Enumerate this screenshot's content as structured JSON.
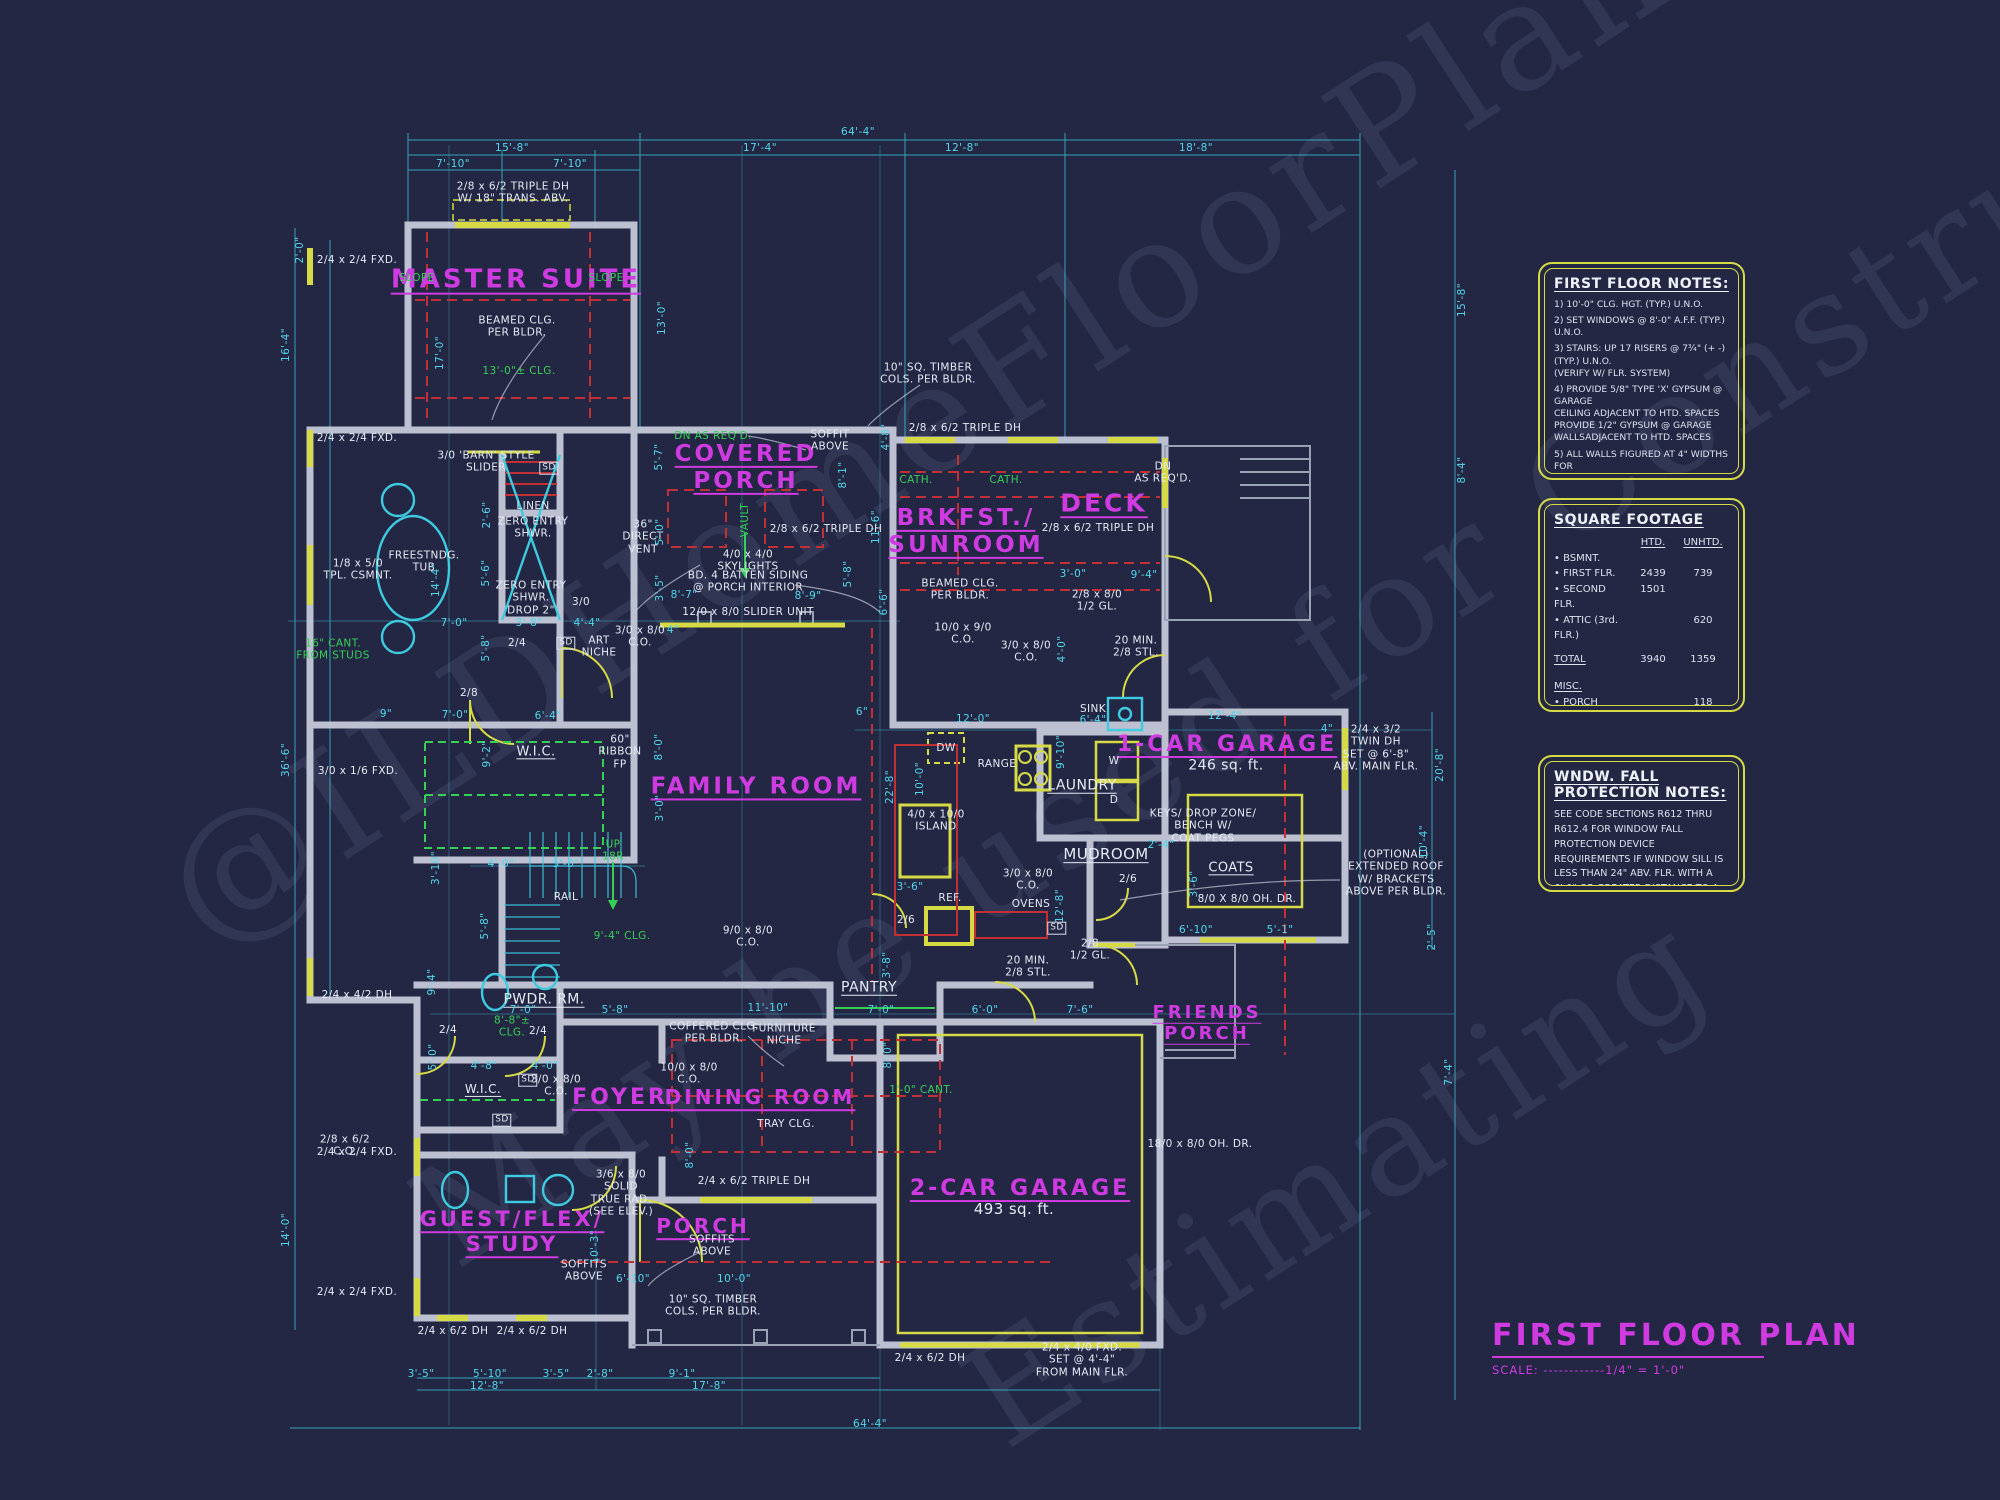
{
  "palette": {
    "background": "#232744",
    "cyan": "#4fd8ea",
    "magenta": "#cf3be0",
    "yellow": "#d6db45",
    "green": "#35d054",
    "red": "#c22f35",
    "white": "#e8ecf4",
    "wall": "#c9cede"
  },
  "watermark": {
    "lines": [
      "@ILDHomeFloorPlans.com",
      "May be used for Construction",
      "Estimating"
    ]
  },
  "title_block": {
    "title": "FIRST FLOOR PLAN",
    "scale": "SCALE: ------------1/4\" = 1'-0\""
  },
  "first_floor_notes": {
    "title": "FIRST FLOOR NOTES:",
    "items": [
      "1) 10'-0\"  CLG. HGT. (TYP.) U.N.O.",
      "2) SET WINDOWS @ 8'-0\" A.F.F. (TYP.) U.N.O.",
      "3) STAIRS: UP 17 RISERS @ 7¾\" (+ -)  (TYP.) U.N.O.\n    (VERIFY W/ FLR. SYSTEM)",
      "4) PROVIDE 5/8\" TYPE 'X' GYPSUM @ GARAGE\n    CEILING ADJACENT TO HTD. SPACES\n    PROVIDE 1/2\" GYPSUM @ GARAGE\n    WALLSADJACENT TO HTD. SPACES",
      "5) ALL WALLS FIGURED AT 4\" WIDTHS FOR\n    FOR STUDS, 9\" WIDTHS FOR STUD/BRICK\n    (TYP.) U.N.O.",
      "6) VERIFY ROUGH OPNG'S,SPECS. FOR CODE\n    REQUIREMENTS WITH WINDOW MANUF.",
      "7) SD = SMOKE DETECTOR",
      "8) INT. DOORS TO BE 8'-0\" H. (VERIFY W/ BLDR.)"
    ]
  },
  "square_footage": {
    "title": "SQUARE FOOTAGE",
    "col_htd": "HTD.",
    "col_unhtd": "UNHTD.",
    "rows": [
      {
        "l": "• BSMNT.",
        "h": "",
        "u": ""
      },
      {
        "l": "• FIRST FLR.",
        "h": "2439",
        "u": "739"
      },
      {
        "l": "• SECOND FLR.",
        "h": "1501",
        "u": ""
      },
      {
        "l": "• ATTIC (3rd. FLR.)",
        "h": "",
        "u": "620"
      }
    ],
    "total": {
      "l": "TOTAL",
      "h": "3940",
      "u": "1359"
    },
    "misc_label": "MISC.",
    "misc_rows": [
      {
        "l": "• PORCH",
        "u": "118"
      },
      {
        "l": "• COVERED PORCH",
        "u": "243"
      },
      {
        "l": "• FRIENDS PORCH",
        "u": "15"
      },
      {
        "l": "• DECK",
        "u": "96"
      },
      {
        "l": "•",
        "u": ""
      }
    ]
  },
  "fall_protection": {
    "title": "WNDW. FALL PROTECTION NOTES:",
    "body": "SEE CODE SECTIONS R612 THRU R612.4 FOR WINDOW FALL PROTECTION DEVICE REQUIREMENTS IF WINDOW SILL IS LESS THAN 24\" ABV. FLR. WITH A 6'-0\" OR GREATER DISTANCE TO A SURFACE OUTSIDE AND BELOW THE WINDOW."
  },
  "plan": {
    "rooms": [
      {
        "t": "MASTER SUITE",
        "x": 516,
        "y": 280,
        "s": 26
      },
      {
        "t": "COVERED\nPORCH",
        "x": 746,
        "y": 468,
        "s": 23
      },
      {
        "t": "BRKFST./\nSUNROOM",
        "x": 966,
        "y": 532,
        "s": 23
      },
      {
        "t": "DECK",
        "x": 1104,
        "y": 503,
        "s": 25
      },
      {
        "t": "FAMILY ROOM",
        "x": 756,
        "y": 787,
        "s": 23
      },
      {
        "t": "1-CAR GARAGE",
        "x": 1227,
        "y": 745,
        "s": 22
      },
      {
        "t": "FRIENDS\nPORCH",
        "x": 1207,
        "y": 1023,
        "s": 18
      },
      {
        "t": "FOYER",
        "x": 620,
        "y": 1098,
        "s": 22
      },
      {
        "t": "DINING ROOM",
        "x": 760,
        "y": 1098,
        "s": 20
      },
      {
        "t": "2-CAR GARAGE",
        "x": 1020,
        "y": 1189,
        "s": 22
      },
      {
        "t": "GUEST/FLEX/\nSTUDY",
        "x": 512,
        "y": 1232,
        "s": 21
      },
      {
        "t": "PORCH",
        "x": 703,
        "y": 1227,
        "s": 20
      }
    ],
    "annotations": [
      {
        "t": "2/8 x 6/2 TRIPLE DH\nW/ 18\" TRANS. ABV.",
        "x": 513,
        "y": 193
      },
      {
        "t": "SLOPE",
        "x": 417,
        "y": 278,
        "c": "g"
      },
      {
        "t": "SLOPE",
        "x": 606,
        "y": 278,
        "c": "g"
      },
      {
        "t": "BEAMED CLG.\nPER BLDR.",
        "x": 517,
        "y": 327
      },
      {
        "t": "13'-0\"± CLG.",
        "x": 519,
        "y": 371,
        "c": "g"
      },
      {
        "t": "2/4 x 2/4 FXD.",
        "x": 357,
        "y": 260
      },
      {
        "t": "2/4 x 2/4 FXD.",
        "x": 357,
        "y": 438
      },
      {
        "t": "3/0 'BARN' STYLE\nSLIDER",
        "x": 486,
        "y": 462
      },
      {
        "t": "SD",
        "x": 549,
        "y": 468,
        "b": 1
      },
      {
        "t": "LINEN",
        "x": 533,
        "y": 506
      },
      {
        "t": "ZERO ENTRY\nSHWR.",
        "x": 533,
        "y": 528
      },
      {
        "t": "ZERO ENTRY\nSHWR.\nDROP 2\"",
        "x": 531,
        "y": 598
      },
      {
        "t": "FREESTNDG.\nTUB",
        "x": 424,
        "y": 562
      },
      {
        "t": "1/8 x 5/0\nTPL. CSMNT.",
        "x": 358,
        "y": 570
      },
      {
        "t": "16\" CANT.\nFROM STUDS",
        "x": 333,
        "y": 650,
        "c": "g"
      },
      {
        "t": "3/0",
        "x": 581,
        "y": 602
      },
      {
        "t": "2/4",
        "x": 517,
        "y": 643
      },
      {
        "t": "SD",
        "x": 566,
        "y": 643,
        "b": 1
      },
      {
        "t": "ART\nNICHE",
        "x": 599,
        "y": 647
      },
      {
        "t": "2/8",
        "x": 469,
        "y": 693
      },
      {
        "t": "DN AS REQ'D.",
        "x": 713,
        "y": 436,
        "c": "g"
      },
      {
        "t": "SOFFIT\nABOVE",
        "x": 830,
        "y": 441
      },
      {
        "t": "VAULT",
        "x": 745,
        "y": 520,
        "c": "g",
        "v": 1
      },
      {
        "t": "2/8 x 6/2 TRIPLE DH",
        "x": 826,
        "y": 529
      },
      {
        "t": "36\"\nDIRECT\nVENT",
        "x": 643,
        "y": 537
      },
      {
        "t": "4/0 x 4/0\nSKYLIGHTS",
        "x": 748,
        "y": 561
      },
      {
        "t": "BD. 4 BATTEN SIDING\n@ PORCH INTERIOR",
        "x": 748,
        "y": 582
      },
      {
        "t": "12/0 x 8/0 SLIDER UNIT",
        "x": 748,
        "y": 612
      },
      {
        "t": "3/0 x 8/0\nC.O.",
        "x": 640,
        "y": 637
      },
      {
        "t": "10\" SQ. TIMBER\nCOLS. PER BLDR.",
        "x": 928,
        "y": 374
      },
      {
        "t": "2/8 x 6/2 TRIPLE DH",
        "x": 965,
        "y": 428
      },
      {
        "t": "CATH.",
        "x": 916,
        "y": 480,
        "c": "g"
      },
      {
        "t": "CATH.",
        "x": 1006,
        "y": 480,
        "c": "g"
      },
      {
        "t": "BEAMED CLG.\nPER BLDR.",
        "x": 960,
        "y": 590
      },
      {
        "t": "10/0 x 9/0\nC.O.",
        "x": 963,
        "y": 634
      },
      {
        "t": "3/0 x 8/0\nC.O.",
        "x": 1026,
        "y": 652
      },
      {
        "t": "DN\nAS REQ'D.",
        "x": 1163,
        "y": 473
      },
      {
        "t": "2/8 x 6/2 TRIPLE DH",
        "x": 1098,
        "y": 528
      },
      {
        "t": "2/8 x 8/0\n1/2 GL.",
        "x": 1097,
        "y": 601
      },
      {
        "t": "20 MIN.\n2/8 STL.",
        "x": 1136,
        "y": 647
      },
      {
        "t": "SINK",
        "x": 1093,
        "y": 709
      },
      {
        "t": "W",
        "x": 1114,
        "y": 761
      },
      {
        "t": "D",
        "x": 1114,
        "y": 800
      },
      {
        "t": "DW",
        "x": 946,
        "y": 748
      },
      {
        "t": "RANGE",
        "x": 997,
        "y": 764
      },
      {
        "t": "4/0 x 10/0\nISLAND",
        "x": 936,
        "y": 821
      },
      {
        "t": "REF.",
        "x": 950,
        "y": 898
      },
      {
        "t": "OVENS",
        "x": 1031,
        "y": 904
      },
      {
        "t": "3/0 x 8/0\nC.O.",
        "x": 1028,
        "y": 880
      },
      {
        "t": "2/6",
        "x": 906,
        "y": 920
      },
      {
        "t": "2/6",
        "x": 1128,
        "y": 879
      },
      {
        "t": "9/0 x 8/0\nC.O.",
        "x": 748,
        "y": 937
      },
      {
        "t": "SD",
        "x": 1057,
        "y": 928,
        "b": 1
      },
      {
        "t": "KEYS/ DROP ZONE/\nBENCH W/\nCOAT PEGS",
        "x": 1203,
        "y": 826
      },
      {
        "t": "8/0 X 8/0 OH. DR.",
        "x": 1247,
        "y": 899
      },
      {
        "t": "2/4 x 3/2\nTWIN DH\nSET @ 6'-8\"\nABV. MAIN FLR.",
        "x": 1376,
        "y": 748
      },
      {
        "t": "(OPTIONAL)\nEXTENDED ROOF\nW/ BRACKETS\nABOVE PER BLDR.",
        "x": 1396,
        "y": 873
      },
      {
        "t": "2/8\n1/2 GL.",
        "x": 1090,
        "y": 950
      },
      {
        "t": "20 MIN.\n2/8 STL.",
        "x": 1028,
        "y": 967
      },
      {
        "t": "UP\n18R",
        "x": 613,
        "y": 851,
        "c": "g"
      },
      {
        "t": "RAIL",
        "x": 566,
        "y": 897
      },
      {
        "t": "9'-4\" CLG.",
        "x": 622,
        "y": 936,
        "c": "g"
      },
      {
        "t": "60\"\nRIBBON\nFP",
        "x": 620,
        "y": 752
      },
      {
        "t": "8'-8\"±\nCLG.",
        "x": 512,
        "y": 1027,
        "c": "g"
      },
      {
        "t": "3/0 x 8/0\nC.O.",
        "x": 556,
        "y": 1086
      },
      {
        "t": "SD",
        "x": 528,
        "y": 1080,
        "b": 1
      },
      {
        "t": "SD",
        "x": 502,
        "y": 1120,
        "b": 1
      },
      {
        "t": "2/4",
        "x": 448,
        "y": 1030
      },
      {
        "t": "2/4",
        "x": 538,
        "y": 1031
      },
      {
        "t": "COFFERED CLG.\nPER BLDR.",
        "x": 714,
        "y": 1033
      },
      {
        "t": "FURNITURE\nNICHE",
        "x": 784,
        "y": 1035
      },
      {
        "t": "10/0 x 8/0\nC.O.",
        "x": 689,
        "y": 1074
      },
      {
        "t": "TRAY CLG.",
        "x": 786,
        "y": 1124
      },
      {
        "t": "1'-0\" CANT.",
        "x": 921,
        "y": 1090,
        "c": "g"
      },
      {
        "t": "2/4 x 6/2 TRIPLE DH",
        "x": 754,
        "y": 1181
      },
      {
        "t": "3/6 x 8/0\nSOLID\nTRUE RAD.\n(SEE ELEV.)",
        "x": 621,
        "y": 1193
      },
      {
        "t": "SOFFITS\nABOVE",
        "x": 584,
        "y": 1271
      },
      {
        "t": "2/8 x 6/2\nC.O.",
        "x": 345,
        "y": 1146
      },
      {
        "t": "3/0 x 1/6 FXD.",
        "x": 358,
        "y": 771
      },
      {
        "t": "2/4 x 4/2 DH",
        "x": 357,
        "y": 995
      },
      {
        "t": "2/4 x 2/4 FXD.",
        "x": 357,
        "y": 1152
      },
      {
        "t": "2/4 x 2/4 FXD.",
        "x": 357,
        "y": 1292
      },
      {
        "t": "2/4 x 6/2 DH",
        "x": 453,
        "y": 1331
      },
      {
        "t": "2/4 x 6/2 DH",
        "x": 532,
        "y": 1331
      },
      {
        "t": "SOFFITS\nABOVE",
        "x": 712,
        "y": 1246
      },
      {
        "t": "10\" SQ. TIMBER\nCOLS. PER BLDR.",
        "x": 713,
        "y": 1306
      },
      {
        "t": "2/4 x 6/2 DH",
        "x": 930,
        "y": 1358
      },
      {
        "t": "2/4 x 4/0 FXD.\nSET @ 4'-4\"\nFROM MAIN FLR.",
        "x": 1082,
        "y": 1360
      },
      {
        "t": "18/0 x 8/0 OH. DR.",
        "x": 1200,
        "y": 1144
      },
      {
        "t": "LAUNDRY",
        "x": 1082,
        "y": 786,
        "u": 1,
        "s": 14
      },
      {
        "t": "MUDROOM",
        "x": 1106,
        "y": 855,
        "u": 1,
        "s": 15
      },
      {
        "t": "COATS",
        "x": 1231,
        "y": 868,
        "u": 1,
        "s": 13
      },
      {
        "t": "PANTRY",
        "x": 869,
        "y": 988,
        "u": 1,
        "s": 14
      },
      {
        "t": "PWDR. RM.",
        "x": 544,
        "y": 1000,
        "u": 1,
        "s": 14
      },
      {
        "t": "W.I.C.",
        "x": 536,
        "y": 752,
        "u": 1,
        "s": 13
      },
      {
        "t": "W.I.C.",
        "x": 483,
        "y": 1089,
        "u": 1,
        "s": 12
      },
      {
        "t": "246 sq. ft.",
        "x": 1226,
        "y": 766,
        "s": 14
      },
      {
        "t": "493 sq. ft.",
        "x": 1014,
        "y": 1210,
        "s": 15
      }
    ],
    "dims": [
      {
        "t": "64'-4\"",
        "x": 858,
        "y": 132
      },
      {
        "t": "15'-8\"",
        "x": 512,
        "y": 148
      },
      {
        "t": "17'-4\"",
        "x": 760,
        "y": 148
      },
      {
        "t": "12'-8\"",
        "x": 962,
        "y": 148
      },
      {
        "t": "18'-8\"",
        "x": 1196,
        "y": 148
      },
      {
        "t": "7'-10\"",
        "x": 453,
        "y": 164
      },
      {
        "t": "7'-10\"",
        "x": 570,
        "y": 164
      },
      {
        "t": "2'-0\"",
        "x": 300,
        "y": 250,
        "v": 1
      },
      {
        "t": "16'-4\"",
        "x": 286,
        "y": 345,
        "v": 1
      },
      {
        "t": "36'-6\"",
        "x": 286,
        "y": 760,
        "v": 1
      },
      {
        "t": "14'-0\"",
        "x": 286,
        "y": 1230,
        "v": 1
      },
      {
        "t": "17'-0\"",
        "x": 440,
        "y": 353,
        "v": 1
      },
      {
        "t": "13'-0\"",
        "x": 662,
        "y": 318,
        "v": 1
      },
      {
        "t": "15'-8\"",
        "x": 1462,
        "y": 300,
        "v": 1
      },
      {
        "t": "8'-4\"",
        "x": 1462,
        "y": 470,
        "v": 1
      },
      {
        "t": "5'-7\"",
        "x": 659,
        "y": 457,
        "v": 1
      },
      {
        "t": "5'-0\"",
        "x": 660,
        "y": 532,
        "v": 1
      },
      {
        "t": "3'-5\"",
        "x": 660,
        "y": 588,
        "v": 1
      },
      {
        "t": "8'-7\"",
        "x": 684,
        "y": 595
      },
      {
        "t": "8'-9\"",
        "x": 808,
        "y": 596
      },
      {
        "t": "8'-1\"",
        "x": 843,
        "y": 475,
        "v": 1
      },
      {
        "t": "5'-8\"",
        "x": 848,
        "y": 574,
        "v": 1
      },
      {
        "t": "11'-6\"",
        "x": 876,
        "y": 527,
        "v": 1
      },
      {
        "t": "6'-6\"",
        "x": 884,
        "y": 602,
        "v": 1
      },
      {
        "t": "4'-8\"",
        "x": 886,
        "y": 437,
        "v": 1
      },
      {
        "t": "4\"",
        "x": 673,
        "y": 630
      },
      {
        "t": "3'-0\"",
        "x": 1073,
        "y": 574
      },
      {
        "t": "9'-4\"",
        "x": 1144,
        "y": 575
      },
      {
        "t": "4'-0\"",
        "x": 1062,
        "y": 649,
        "v": 1
      },
      {
        "t": "12'-0\"",
        "x": 973,
        "y": 719
      },
      {
        "t": "6'-4\"",
        "x": 1093,
        "y": 720
      },
      {
        "t": "6\"",
        "x": 862,
        "y": 712
      },
      {
        "t": "22'-8\"",
        "x": 890,
        "y": 787,
        "v": 1
      },
      {
        "t": "10'-0\"",
        "x": 920,
        "y": 779,
        "v": 1
      },
      {
        "t": "9'-10\"",
        "x": 1061,
        "y": 752,
        "v": 1
      },
      {
        "t": "12'-8\"",
        "x": 1060,
        "y": 906,
        "v": 1
      },
      {
        "t": "3'-6\"",
        "x": 910,
        "y": 887
      },
      {
        "t": "12'-4\"",
        "x": 1225,
        "y": 716
      },
      {
        "t": "4\"",
        "x": 1327,
        "y": 729
      },
      {
        "t": "20'-8\"",
        "x": 1440,
        "y": 765,
        "v": 1
      },
      {
        "t": "10'-4\"",
        "x": 1424,
        "y": 842,
        "v": 1
      },
      {
        "t": "2'-4\"",
        "x": 1161,
        "y": 845
      },
      {
        "t": "3'-6\"",
        "x": 1194,
        "y": 884,
        "v": 1
      },
      {
        "t": "6'-10\"",
        "x": 1196,
        "y": 930
      },
      {
        "t": "5'-1\"",
        "x": 1280,
        "y": 930
      },
      {
        "t": "2'-5\"",
        "x": 1432,
        "y": 937,
        "v": 1
      },
      {
        "t": "7'-4\"",
        "x": 1449,
        "y": 1072,
        "v": 1
      },
      {
        "t": "9'-2\"",
        "x": 487,
        "y": 754,
        "v": 1
      },
      {
        "t": "4'-0\"",
        "x": 501,
        "y": 864
      },
      {
        "t": "5'-0\"",
        "x": 566,
        "y": 864
      },
      {
        "t": "5'-8\"",
        "x": 485,
        "y": 926,
        "v": 1
      },
      {
        "t": "8'-0\"",
        "x": 659,
        "y": 747,
        "v": 1
      },
      {
        "t": "3'-0\"",
        "x": 660,
        "y": 808,
        "v": 1
      },
      {
        "t": "2'-6\"",
        "x": 487,
        "y": 515,
        "v": 1
      },
      {
        "t": "5'-6\"",
        "x": 486,
        "y": 573,
        "v": 1
      },
      {
        "t": "5'-8\"",
        "x": 486,
        "y": 648,
        "v": 1
      },
      {
        "t": "7'-0\"",
        "x": 454,
        "y": 623
      },
      {
        "t": "3'-8\"",
        "x": 529,
        "y": 623
      },
      {
        "t": "4'-4\"",
        "x": 587,
        "y": 623
      },
      {
        "t": "7'-0\"",
        "x": 455,
        "y": 715
      },
      {
        "t": "6'-4\"",
        "x": 548,
        "y": 716
      },
      {
        "t": "9\"",
        "x": 386,
        "y": 714
      },
      {
        "t": "14'-4\"",
        "x": 436,
        "y": 580,
        "v": 1
      },
      {
        "t": "9'-4\"",
        "x": 432,
        "y": 982,
        "v": 1
      },
      {
        "t": "5'-0\"",
        "x": 433,
        "y": 1057,
        "v": 1
      },
      {
        "t": "3'-10\"",
        "x": 436,
        "y": 868,
        "v": 1
      },
      {
        "t": "7'-0\"",
        "x": 523,
        "y": 1010
      },
      {
        "t": "5'-8\"",
        "x": 615,
        "y": 1010
      },
      {
        "t": "11'-10\"",
        "x": 768,
        "y": 1008
      },
      {
        "t": "7'-0\"",
        "x": 881,
        "y": 1010
      },
      {
        "t": "6'-0\"",
        "x": 985,
        "y": 1010
      },
      {
        "t": "7'-6\"",
        "x": 1080,
        "y": 1010
      },
      {
        "t": "3'-8\"",
        "x": 887,
        "y": 965,
        "v": 1
      },
      {
        "t": "8'-0\"",
        "x": 888,
        "y": 1055,
        "v": 1
      },
      {
        "t": "4'-8\"",
        "x": 484,
        "y": 1066
      },
      {
        "t": "4'-0\"",
        "x": 545,
        "y": 1066
      },
      {
        "t": "10'-3\"",
        "x": 595,
        "y": 1247,
        "v": 1
      },
      {
        "t": "6'-10\"",
        "x": 633,
        "y": 1279
      },
      {
        "t": "10'-0\"",
        "x": 734,
        "y": 1279
      },
      {
        "t": "3'-5\"",
        "x": 421,
        "y": 1374
      },
      {
        "t": "5'-10\"",
        "x": 490,
        "y": 1374
      },
      {
        "t": "3'-5\"",
        "x": 556,
        "y": 1374
      },
      {
        "t": "2'-8\"",
        "x": 600,
        "y": 1374
      },
      {
        "t": "9'-1\"",
        "x": 682,
        "y": 1374
      },
      {
        "t": "12'-8\"",
        "x": 487,
        "y": 1386
      },
      {
        "t": "17'-8\"",
        "x": 709,
        "y": 1386
      },
      {
        "t": "64'-4\"",
        "x": 870,
        "y": 1424
      },
      {
        "t": "8'-0\"",
        "x": 690,
        "y": 1155,
        "v": 1
      }
    ]
  }
}
